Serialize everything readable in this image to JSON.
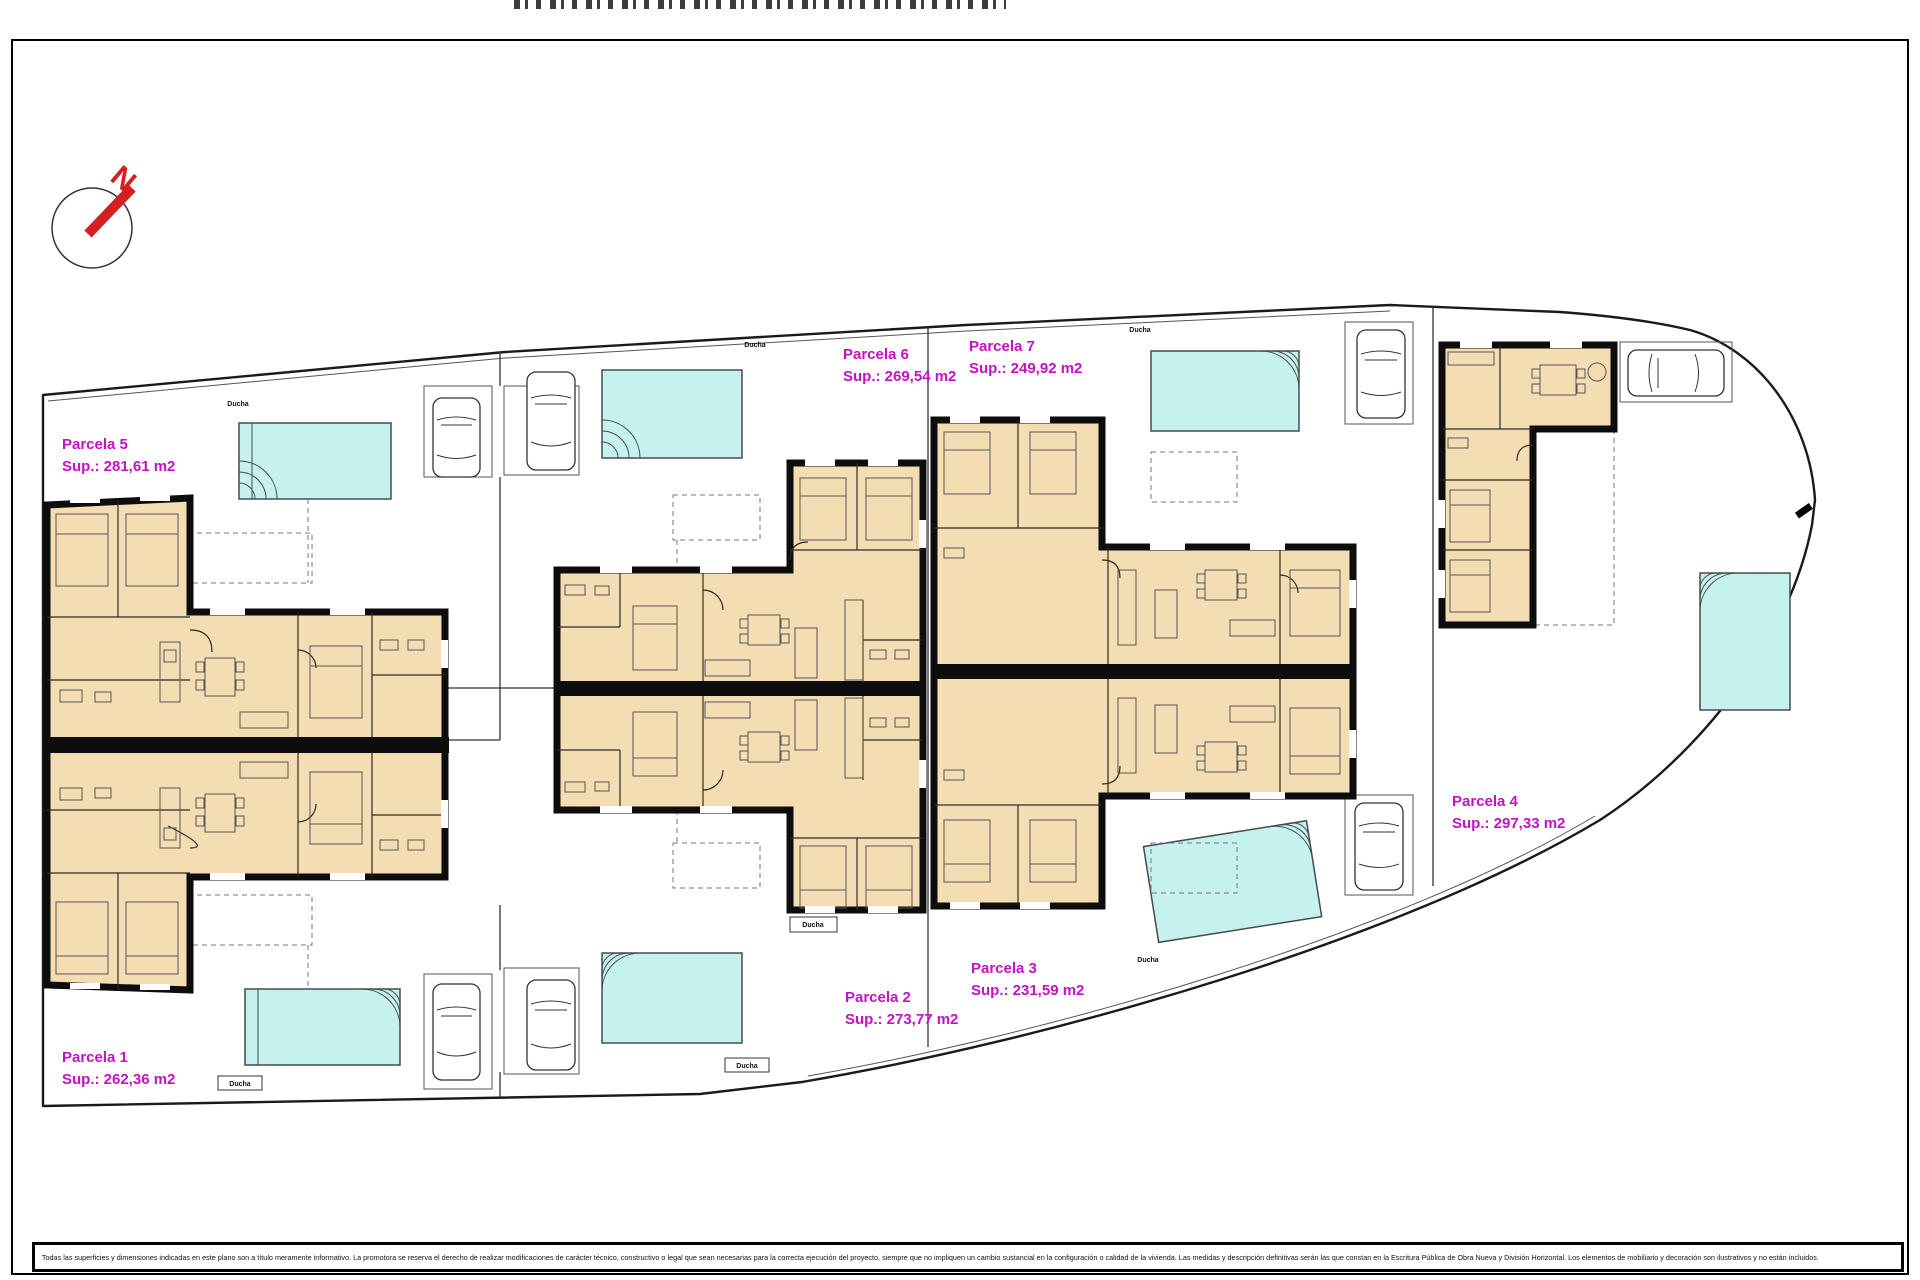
{
  "plan": {
    "compass_letter": "N",
    "shower_label": "Ducha",
    "disclaimer": "Todas las superficies y dimensiones indicadas en este plano son a título meramente informativo. La promotora se reserva el derecho de realizar modificaciones de carácter técnico, constructivo o legal que sean necesarias para la correcta ejecución del proyecto, siempre que no impliquen un cambio sustancial en la configuración o calidad de la vivienda. Las medidas y descripción definitivas serán las que constan en la Escritura Pública de Obra Nueva y División Horizontal. Los elementos de mobiliario y decoración son ilustrativos y no están incluidos.",
    "parcels": [
      {
        "name": "Parcela 1",
        "area": "Sup.: 262,36 m2"
      },
      {
        "name": "Parcela 2",
        "area": "Sup.: 273,77 m2"
      },
      {
        "name": "Parcela 3",
        "area": "Sup.: 231,59 m2"
      },
      {
        "name": "Parcela 4",
        "area": "Sup.: 297,33 m2"
      },
      {
        "name": "Parcela 5",
        "area": "Sup.: 281,61 m2"
      },
      {
        "name": "Parcela 6",
        "area": "Sup.: 269,54 m2"
      },
      {
        "name": "Parcela 7",
        "area": "Sup.: 249,92 m2"
      }
    ],
    "colors": {
      "room_fill": "#F4DDB2",
      "wall": "#0d0d0d",
      "pool_fill": "#C5F1EF",
      "pool_border": "#4a4a4a",
      "parcel_label": "#C511C5",
      "compass_red": "#D42020",
      "line": "#2b2b2b"
    }
  }
}
